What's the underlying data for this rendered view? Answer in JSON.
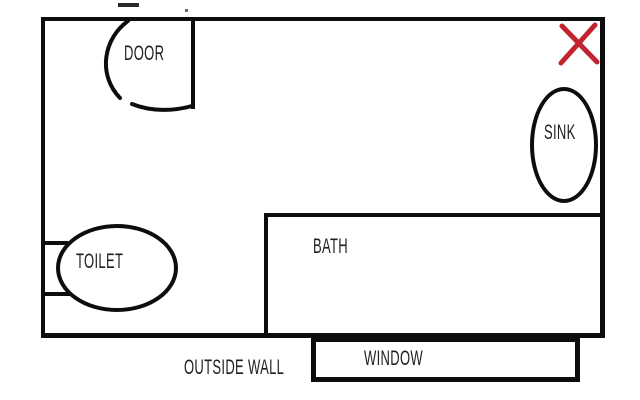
{
  "floor_plan": {
    "type": "bathroom-floor-plan",
    "labels": {
      "door": "DOOR",
      "sink": "SINK",
      "toilet": "TOILET",
      "bath": "BATH",
      "window": "WINDOW",
      "outside_wall": "OUTSIDE WALL"
    },
    "marks": {
      "x_mark": "red-x-mark"
    },
    "colors": {
      "ink": "#0d0d0d",
      "label_ink": "#1f1f1f",
      "x_mark_red": "#c2242f",
      "background": "#ffffff"
    }
  }
}
